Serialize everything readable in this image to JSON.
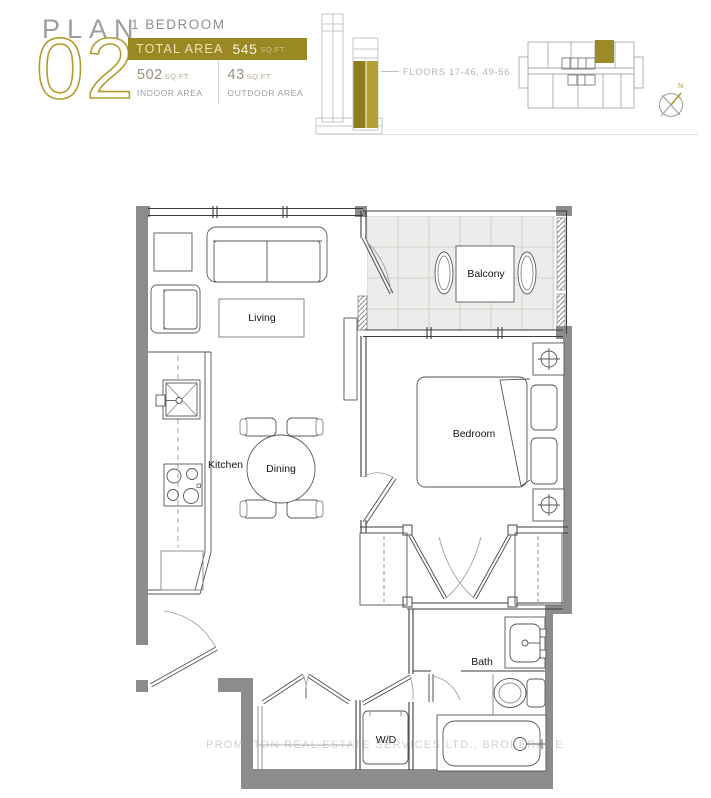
{
  "header": {
    "plan_label": "PLAN",
    "plan_number": "02",
    "unit_type": "1 BEDROOM",
    "total_area_label": "TOTAL AREA",
    "total_area_value": "545",
    "sqft_unit": "SQ.FT.",
    "indoor": {
      "value": "502",
      "unit": "SQ.FT.",
      "label": "INDOOR AREA"
    },
    "outdoor": {
      "value": "43",
      "unit": "SQ.FT.",
      "label": "OUTDOOR AREA"
    }
  },
  "building": {
    "floors_callout": "FLOORS 17-46, 49-56",
    "compass_north": "N"
  },
  "floor_plan": {
    "labels": {
      "living": "Living",
      "dining": "Dining",
      "kitchen": "Kitchen",
      "bedroom": "Bedroom",
      "balcony": "Balcony",
      "bath": "Bath",
      "washer_dryer": "W/D"
    }
  },
  "watermark": "PROMPTON REAL ESTATE SERVICES LTD., BROKERAGE",
  "colors": {
    "gold": "#9a8822",
    "gold_light": "#b3a136",
    "gold_dark": "#8f7c1f",
    "wall_gray": "#8c8c8c"
  }
}
